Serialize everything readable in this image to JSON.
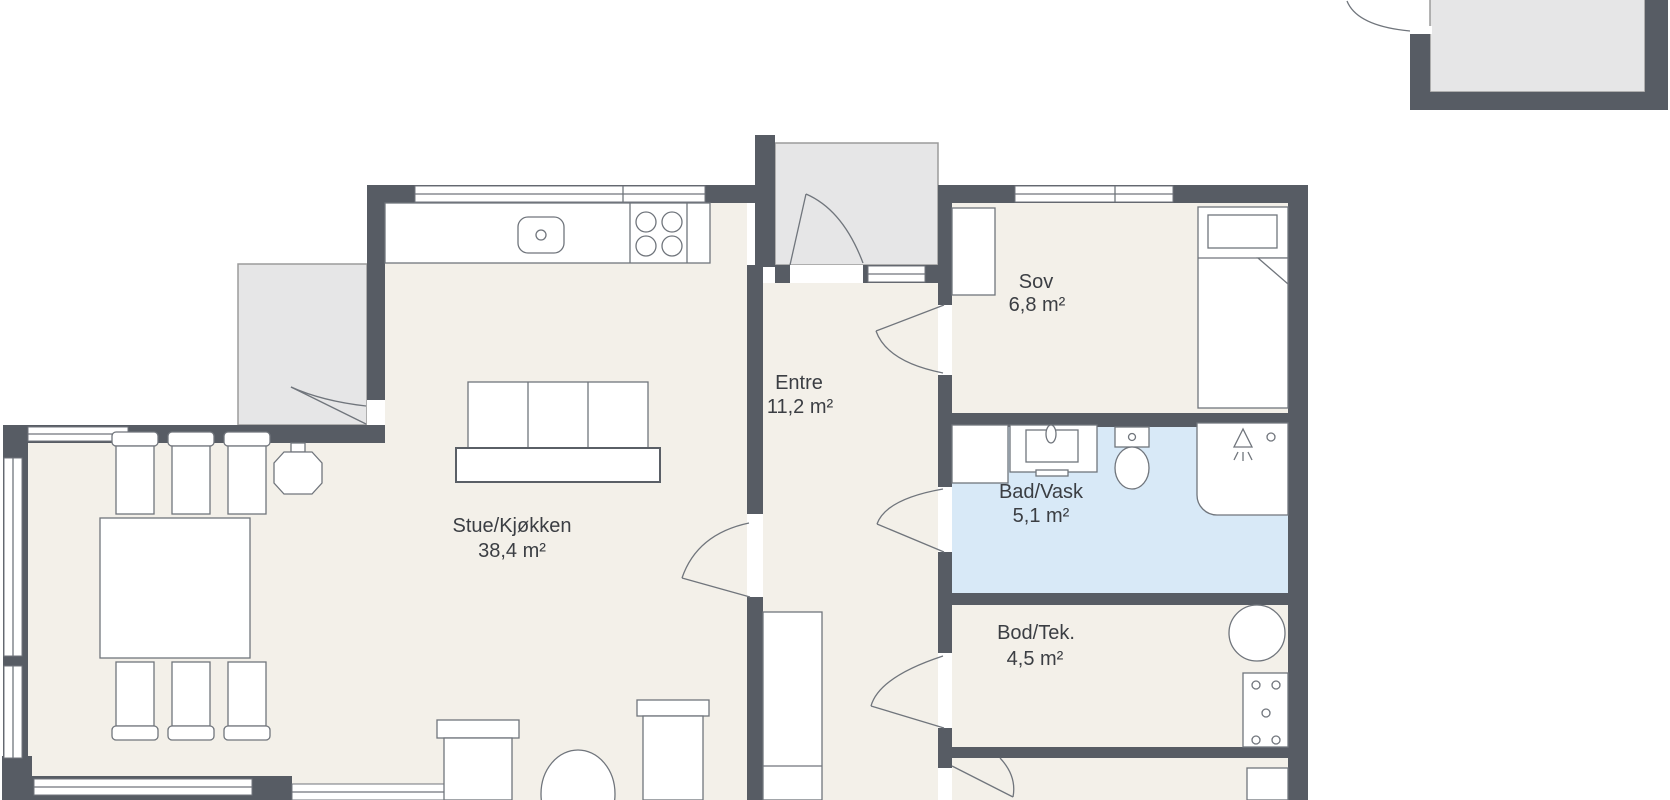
{
  "rooms": [
    {
      "name": "Stue/Kjøkken",
      "area": "38,4 m²"
    },
    {
      "name": "Entre",
      "area": "11,2 m²"
    },
    {
      "name": "Sov",
      "area": "6,8 m²"
    },
    {
      "name": "Bad/Vask",
      "area": "5,1 m²"
    },
    {
      "name": "Bod/Tek.",
      "area": "4,5 m²"
    }
  ],
  "fixtures": [
    "kitchen-sink-icon",
    "stove-icon",
    "dining-table",
    "dining-chair",
    "pendant-lamp-icon",
    "sofa",
    "armchair",
    "side-table",
    "terrace",
    "entry-porch",
    "front-door",
    "window",
    "wardrobe",
    "closet",
    "bed",
    "washing-machine-icon",
    "bathroom-sink-icon",
    "toilet-icon",
    "shower-icon",
    "water-heater-icon",
    "electrical-panel-icon",
    "door-swing",
    "annex"
  ],
  "colors": {
    "wall": "#575c64",
    "floor": "#f3f0e9",
    "bathroom_floor": "#d8e9f7",
    "outdoor": "#e6e6e7",
    "outline": "#70757c",
    "text": "#3b3e43",
    "background": "#ffffff"
  }
}
